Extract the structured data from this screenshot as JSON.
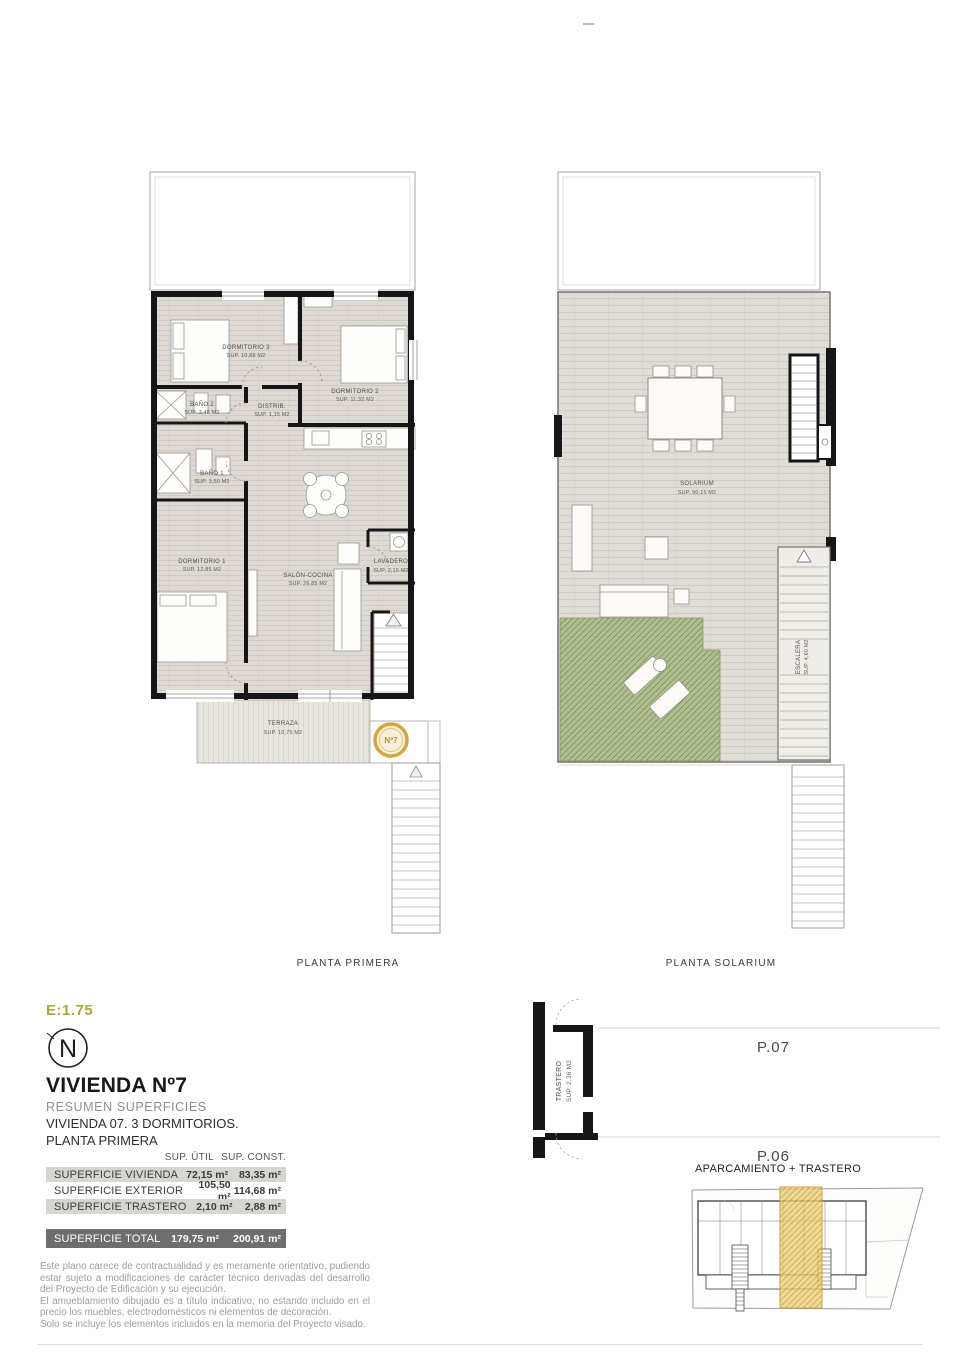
{
  "colors": {
    "accent_gold": "#D2A73E",
    "scale_text": "#ACA63C",
    "floor_gray": "#DEDAD3",
    "green_area": "#A9BB8B",
    "wall_black": "#161616",
    "table_row_bg": "#D7D5D1",
    "table_total_bg": "#6E6E6E"
  },
  "page": {
    "scale": "E:1.75",
    "north_letter": "N"
  },
  "plan_primera": {
    "caption": "PLANTA PRIMERA",
    "badge": "Nº7",
    "rooms": {
      "dorm3": {
        "name": "DORMITORIO 3",
        "sup": "SUP. 10,88 M2"
      },
      "dorm2": {
        "name": "DORMITORIO 2",
        "sup": "SUP. 11,32 M2"
      },
      "bano2": {
        "name": "BAÑO 2",
        "sup": "SUP. 3,45 M2"
      },
      "distrib": {
        "name": "DISTRIB.",
        "sup": "SUP. 1,15 M2"
      },
      "bano1": {
        "name": "BAÑO 1",
        "sup": "SUP. 3,50 M2"
      },
      "dorm1": {
        "name": "DORMITORIO 1",
        "sup": "SUP. 12,85 M2"
      },
      "salon": {
        "name": "SALÓN-COCINA",
        "sup": "SUP. 26,85 M2"
      },
      "lavadero": {
        "name": "LAVADERO",
        "sup": "SUP. 2,15 M2"
      },
      "terraza": {
        "name": "TERRAZA",
        "sup": "SUP. 10,75 M2"
      }
    }
  },
  "plan_solarium": {
    "caption": "PLANTA SOLARIUM",
    "rooms": {
      "solarium": {
        "name": "SOLARIUM",
        "sup": "SUP. 90,15 M2"
      },
      "escalera": {
        "name": "ESCALERA",
        "sup": "SUP. 4,60 M2"
      }
    }
  },
  "trastero": {
    "name": "TRASTERO",
    "sup": "SUP. 2,36 M2",
    "p07": "P.07",
    "p06": "P.06",
    "caption": "APARCAMIENTO + TRASTERO"
  },
  "summary": {
    "title": "VIVIENDA Nº7",
    "subtitle": "RESUMEN SUPERFICIES",
    "desc1": "VIVIENDA 07. 3 DORMITORIOS.",
    "desc2": "PLANTA PRIMERA",
    "col_util": "SUP. ÚTIL",
    "col_const": "SUP. CONST.",
    "rows": [
      {
        "label": "SUPERFICIE VIVIENDA",
        "util": "72,15 m²",
        "constr": "83,35 m²"
      },
      {
        "label": "SUPERFICIE EXTERIOR",
        "util": "105,50 m²",
        "constr": "114,68 m²"
      },
      {
        "label": "SUPERFICIE TRASTERO",
        "util": "2,10 m²",
        "constr": "2,88 m²"
      }
    ],
    "total": {
      "label": "SUPERFICIE TOTAL",
      "util": "179,75 m²",
      "constr": "200,91 m²"
    }
  },
  "disclaimer": {
    "p1": "Este plano carece de contractualidad y es meramente orientativo, pudiendo estar sujeto a modificaciones de carácter técnico derivadas del desarrollo del Proyecto de Edificación y su ejecución.",
    "p2": "El amueblamiento dibujado es a título indicativo, no estando incluido en el precio los muebles, electrodomésticos ni elementos de decoración.",
    "p3": "Solo se incluye los elementos incluidos en la memoria del Proyecto visado."
  }
}
